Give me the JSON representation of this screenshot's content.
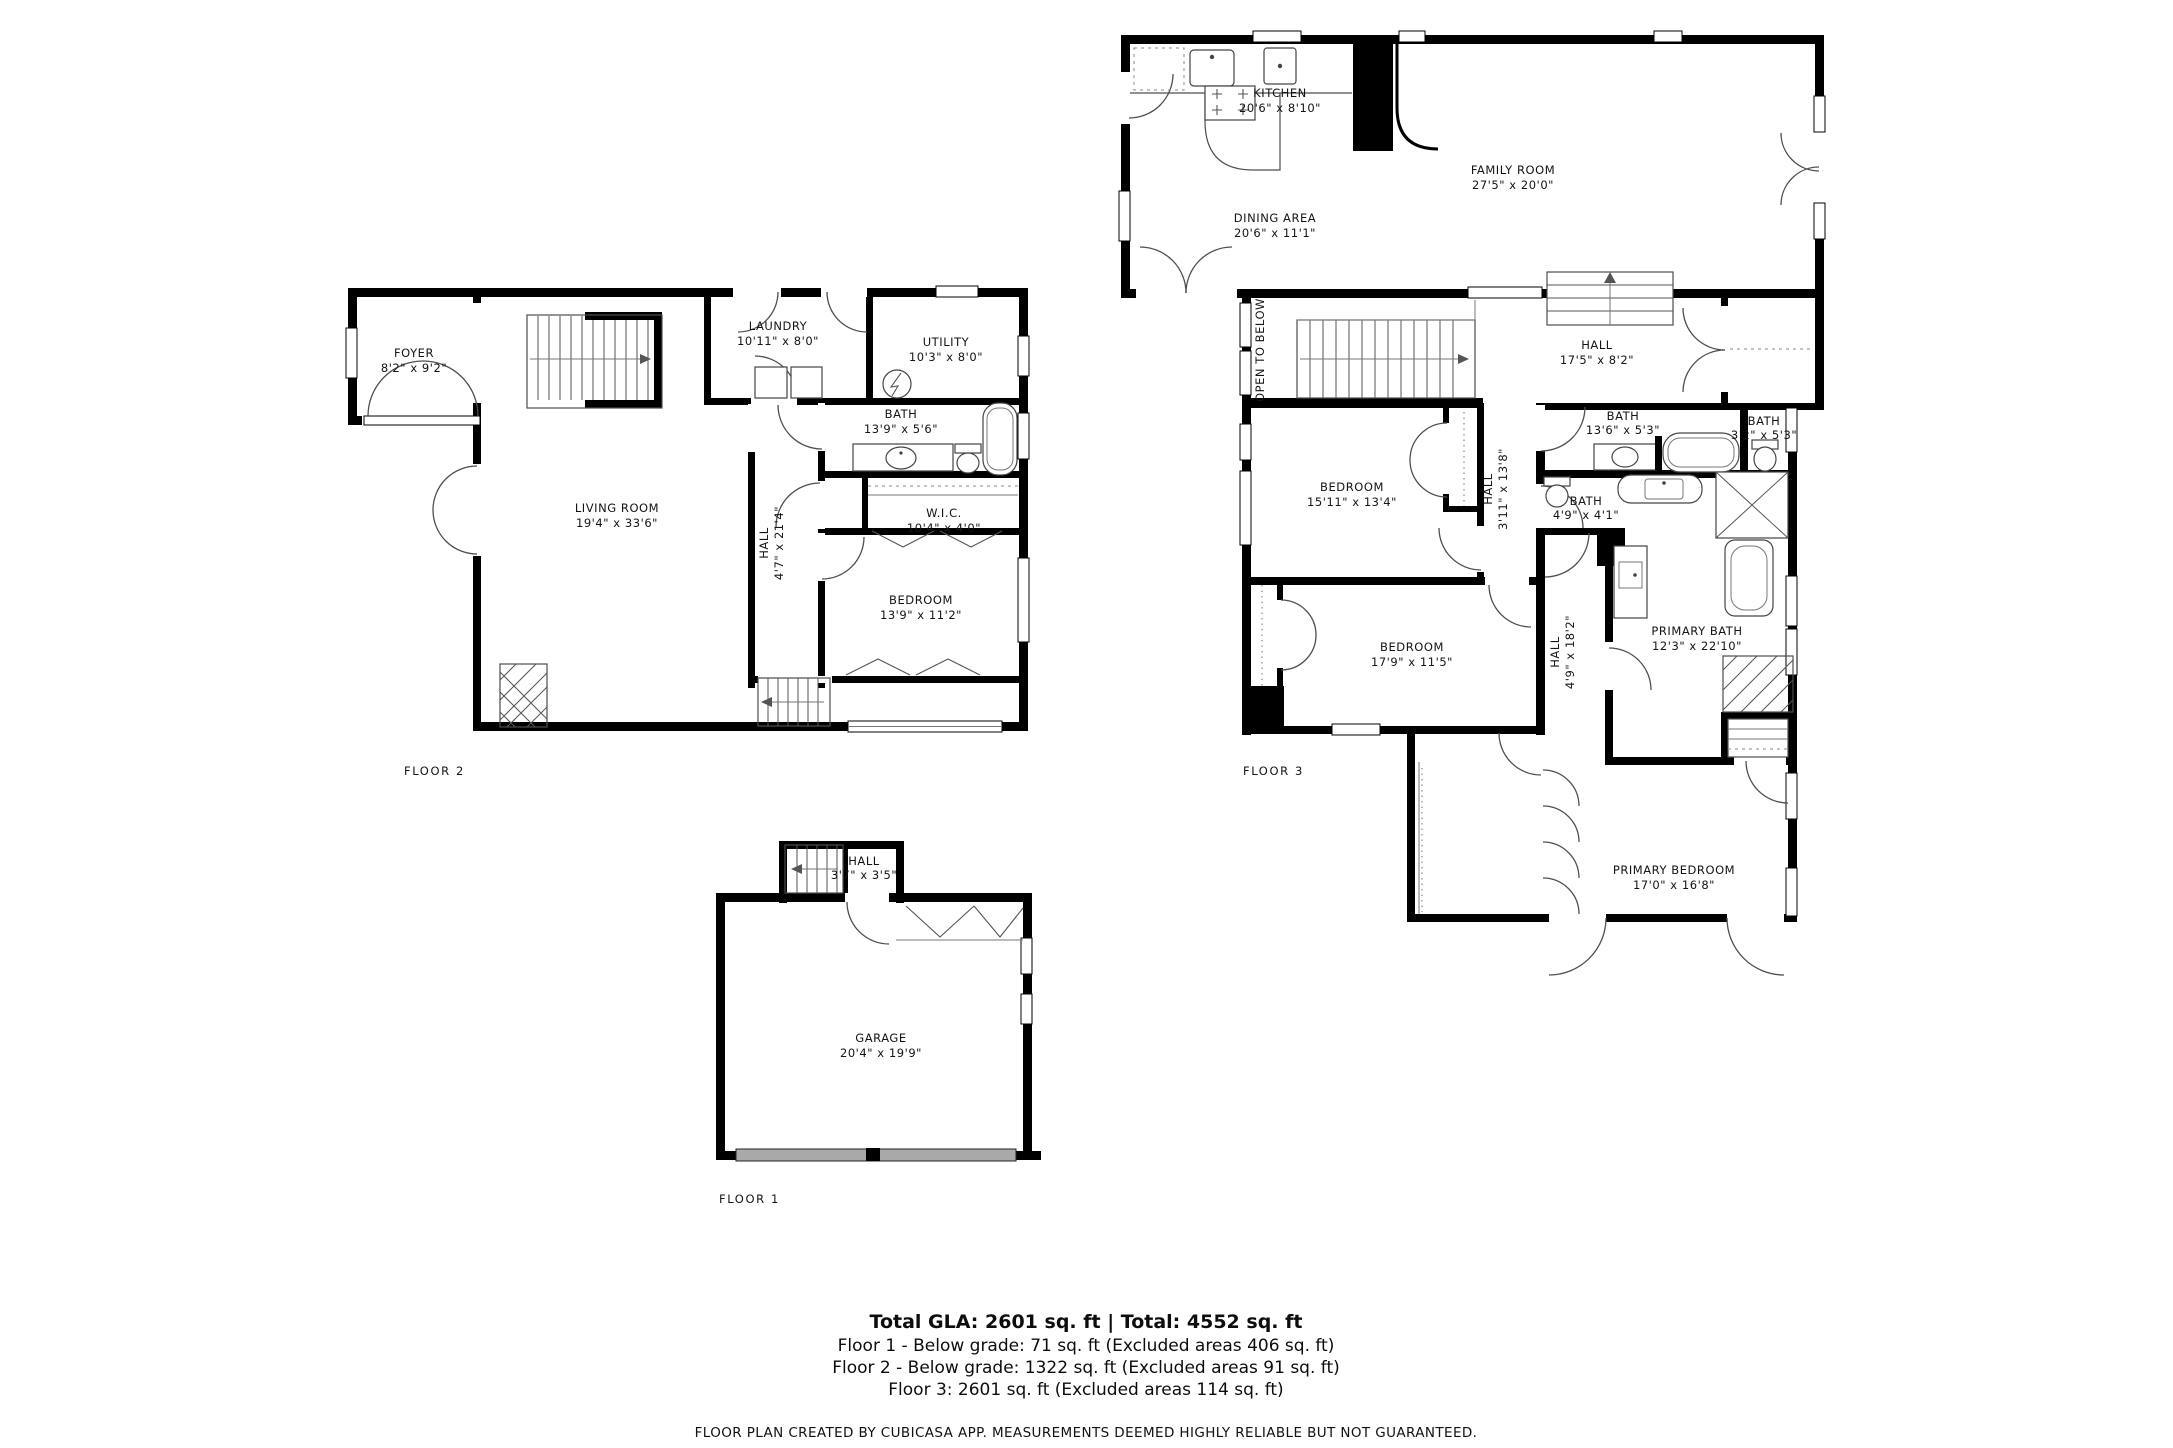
{
  "floors": {
    "floor1": {
      "label": "FLOOR 1",
      "rooms": {
        "hall": {
          "name": "HALL",
          "dims": "3'7\" x 3'5\""
        },
        "garage": {
          "name": "GARAGE",
          "dims": "20'4\" x 19'9\""
        }
      }
    },
    "floor2": {
      "label": "FLOOR 2",
      "rooms": {
        "foyer": {
          "name": "FOYER",
          "dims": "8'2\" x 9'2\""
        },
        "laundry": {
          "name": "LAUNDRY",
          "dims": "10'11\" x 8'0\""
        },
        "utility": {
          "name": "UTILITY",
          "dims": "10'3\" x 8'0\""
        },
        "bath": {
          "name": "BATH",
          "dims": "13'9\" x 5'6\""
        },
        "wic": {
          "name": "W.I.C.",
          "dims": "10'4\" x 4'0\""
        },
        "living_room": {
          "name": "LIVING ROOM",
          "dims": "19'4\" x 33'6\""
        },
        "hall": {
          "name": "HALL",
          "dims": "4'7\" x 21'4\""
        },
        "bedroom": {
          "name": "BEDROOM",
          "dims": "13'9\" x 11'2\""
        }
      }
    },
    "floor3": {
      "label": "FLOOR 3",
      "rooms": {
        "kitchen": {
          "name": "KITCHEN",
          "dims": "20'6\" x 8'10\""
        },
        "dining_area": {
          "name": "DINING AREA",
          "dims": "20'6\" x 11'1\""
        },
        "family_room": {
          "name": "FAMILY ROOM",
          "dims": "27'5\" x 20'0\""
        },
        "open_to_below": {
          "name": "OPEN TO BELOW"
        },
        "hall_upper": {
          "name": "HALL",
          "dims": "17'5\" x 8'2\""
        },
        "bath_main": {
          "name": "BATH",
          "dims": "13'6\" x 5'3\""
        },
        "bath_small": {
          "name": "BATH",
          "dims": "3'2\" x 5'3\""
        },
        "bath_powder": {
          "name": "BATH",
          "dims": "4'9\" x 4'1\""
        },
        "hall_mid": {
          "name": "HALL",
          "dims": "3'11\" x 13'8\""
        },
        "bedroom_upper": {
          "name": "BEDROOM",
          "dims": "15'11\" x 13'4\""
        },
        "bedroom_lower": {
          "name": "BEDROOM",
          "dims": "17'9\" x 11'5\""
        },
        "hall_lower": {
          "name": "HALL",
          "dims": "4'9\" x 18'2\""
        },
        "primary_bath": {
          "name": "PRIMARY BATH",
          "dims": "12'3\" x 22'10\""
        },
        "primary_bedroom": {
          "name": "PRIMARY BEDROOM",
          "dims": "17'0\" x 16'8\""
        }
      }
    }
  },
  "summary": {
    "total_line": "Total GLA: 2601 sq. ft | Total: 4552 sq. ft",
    "floor1_line": "Floor 1 - Below grade: 71 sq. ft (Excluded areas 406 sq. ft)",
    "floor2_line": "Floor 2 - Below grade: 1322 sq. ft (Excluded areas 91 sq. ft)",
    "floor3_line": "Floor 3: 2601 sq. ft (Excluded areas 114 sq. ft)",
    "disclaimer": "FLOOR PLAN CREATED BY CUBICASA APP. MEASUREMENTS DEEMED HIGHLY RELIABLE BUT NOT GUARANTEED."
  },
  "colors": {
    "wall": "#000000",
    "line": "#4d4d4d",
    "garage": "#a9a9a9"
  }
}
